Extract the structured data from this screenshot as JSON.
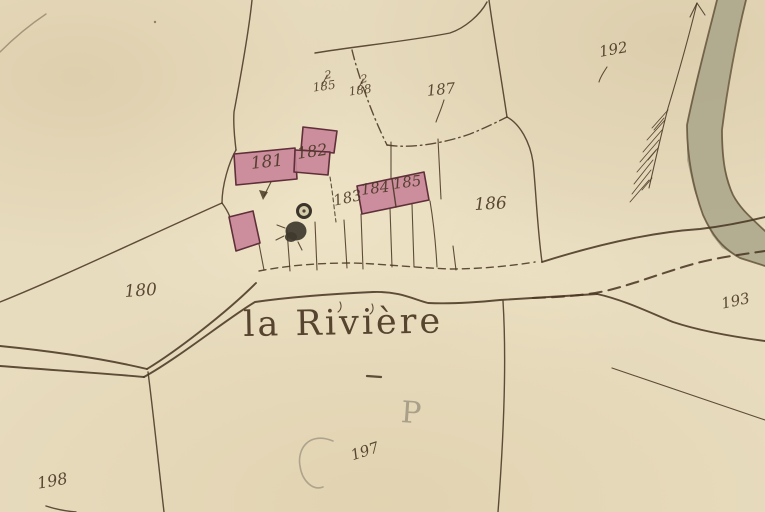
{
  "place": {
    "name": "la Rivière"
  },
  "parcel_labels": {
    "p180": "180",
    "p181": "181",
    "p182": "182",
    "p183": "183",
    "p184": "184",
    "p185": "185",
    "p186": "186",
    "p187": "187",
    "p192": "192",
    "p193": "193",
    "p197": "197",
    "p198": "198"
  },
  "fractions": {
    "left": {
      "num": "2",
      "den": "185"
    },
    "right": {
      "num": "2",
      "den": "188"
    }
  },
  "pencil_annotations": {
    "letter": "P"
  },
  "symbols": {
    "river": "river-band",
    "branch": "feathered-branch-icon",
    "wells": "well-markers",
    "arrow": "parcel-pointer-arrow",
    "underline": "place-name-dash"
  },
  "colors": {
    "paper": "#e8dcbf",
    "ink": "#4a3824",
    "building-fill": "#c9879a",
    "building-stroke": "#5f2f3a",
    "river-fill": "#a9a489",
    "river-bank": "#5f4e33",
    "pencil": "#978e7c",
    "well": "#3e382e"
  }
}
